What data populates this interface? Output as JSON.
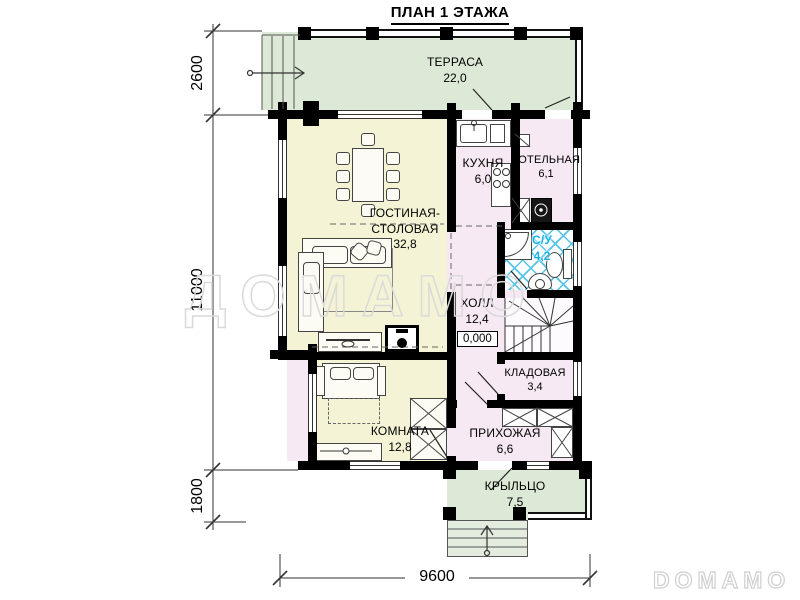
{
  "title": "ПЛАН 1 ЭТАЖА",
  "rooms": {
    "terrace": {
      "name": "ТЕРРАСА",
      "area": "22,0"
    },
    "kitchen": {
      "name": "КУХНЯ",
      "area": "6,0"
    },
    "boiler": {
      "name": "КОТЕЛЬНАЯ",
      "area": "6,1"
    },
    "living": {
      "name": "ГОСТИНАЯ-СТОЛОВАЯ",
      "area": "32,8"
    },
    "bathroom": {
      "name": "С/У",
      "area": "4,2"
    },
    "hall": {
      "name": "ХОЛЛ",
      "area": "12,4"
    },
    "storage": {
      "name": "КЛАДОВАЯ",
      "area": "3,4"
    },
    "room": {
      "name": "КОМНАТА",
      "area": "12,8"
    },
    "hallway": {
      "name": "ПРИХОЖАЯ",
      "area": "6,6"
    },
    "porch": {
      "name": "КРЫЛЬЦО",
      "area": "7,5"
    }
  },
  "elevation_mark": "0,000",
  "dimensions": {
    "terrace_depth": "2600",
    "house_depth": "11000",
    "porch_depth": "1800",
    "total_width": "9600"
  },
  "watermarks": {
    "center": "ДОМАМО",
    "corner": "DOMAMO"
  },
  "colors": {
    "terrace": "#dde9d7",
    "warm": "#f5f3d5",
    "cool": "#f6e9f4",
    "steps": "#e4ecdf",
    "tile": "#56c3e9",
    "wall": "#000000"
  }
}
